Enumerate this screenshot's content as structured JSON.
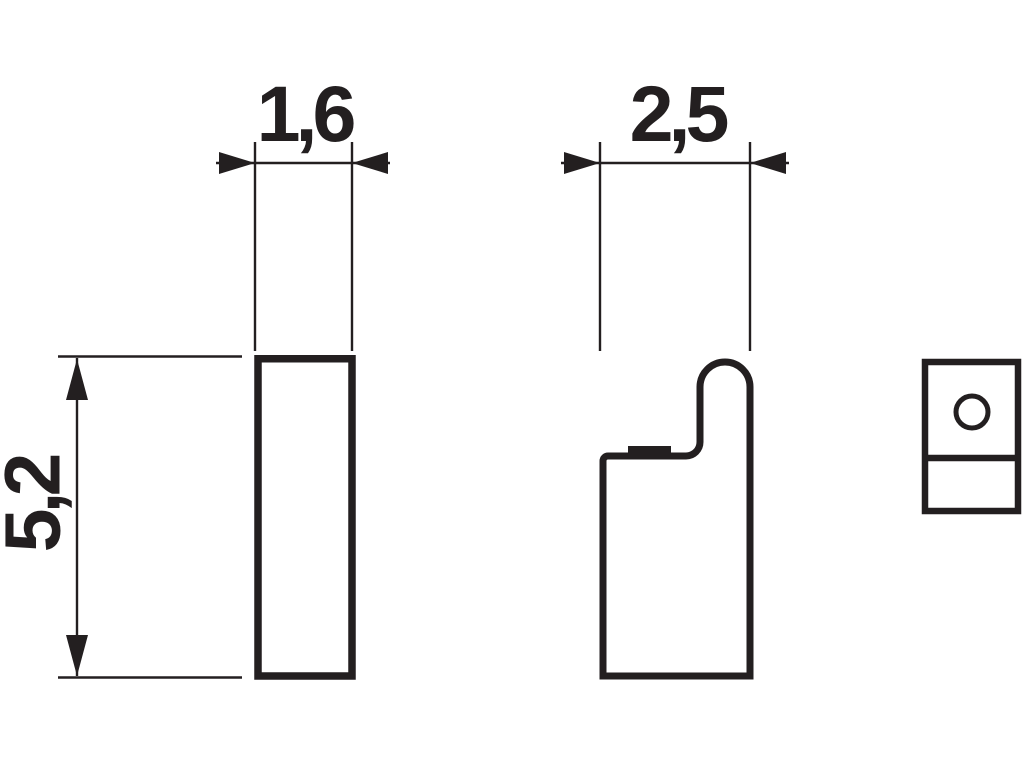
{
  "drawing": {
    "background_color": "#ffffff",
    "line_color": "#231f20",
    "dimensions": {
      "front_width": "1,6",
      "side_depth": "2,5",
      "height": "5,2"
    },
    "views": {
      "front": "front-view-plate",
      "side": "side-view-hook-profile",
      "end": "end-view-with-hole"
    }
  }
}
